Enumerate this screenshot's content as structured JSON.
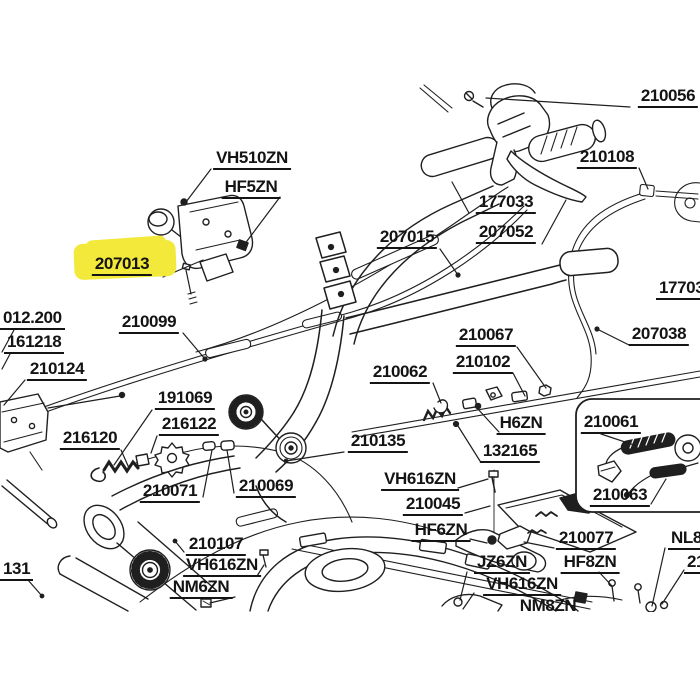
{
  "diagram": {
    "kind": "exploded-parts-diagram",
    "subject": "handlebar and control cable assembly line drawing",
    "colors": {
      "background": "#ffffff",
      "line": "#1f1f1f",
      "highlight": "#f2e93a"
    },
    "highlighted_part": "207013",
    "labels": [
      "210056",
      "VH510ZN",
      "HF5ZN",
      "207013",
      "177033",
      "207052",
      "210108",
      "207015",
      "17703",
      "207038",
      "012.200",
      "161218",
      "210124",
      "210099",
      "191069",
      "216122",
      "216120",
      "210135",
      "210062",
      "210067",
      "210102",
      "H6ZN",
      "132165",
      "210061",
      "210063",
      "210071",
      "210069",
      "VH616ZN",
      "210045",
      "HF6ZN",
      "210107",
      "VH616ZN",
      "NM6ZN",
      "131",
      "JZ6ZN",
      "VH616ZN",
      "NM8ZN",
      "210077",
      "HF8ZN",
      "NL8",
      "21"
    ]
  }
}
